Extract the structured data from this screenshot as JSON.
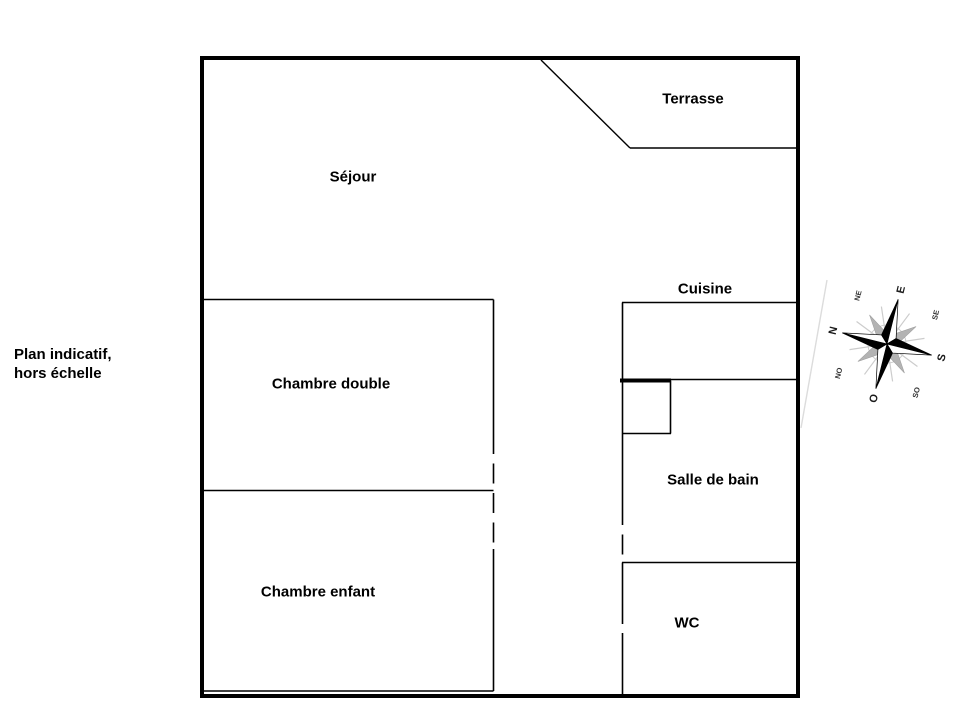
{
  "plan": {
    "note_line1": "Plan indicatif,",
    "note_line2": "hors échelle",
    "rooms": [
      {
        "label": "Terrasse"
      },
      {
        "label": "Séjour"
      },
      {
        "label": "Cuisine"
      },
      {
        "label": "Chambre double"
      },
      {
        "label": "Salle de bain"
      },
      {
        "label": "Chambre enfant"
      },
      {
        "label": "WC"
      }
    ]
  },
  "compass": {
    "rotation_deg": -76,
    "cardinals": {
      "n": "N",
      "e": "E",
      "s": "S",
      "o": "O"
    },
    "intercardinals": {
      "ne": "NE",
      "se": "SE",
      "so": "SO",
      "no": "NO"
    }
  },
  "colors": {
    "background": "#ffffff",
    "wall": "#000000",
    "compass_main": "#000000",
    "compass_secondary": "#b3b3b3",
    "compass_rays": "#cccccc",
    "crease": "#dcdcdc"
  }
}
